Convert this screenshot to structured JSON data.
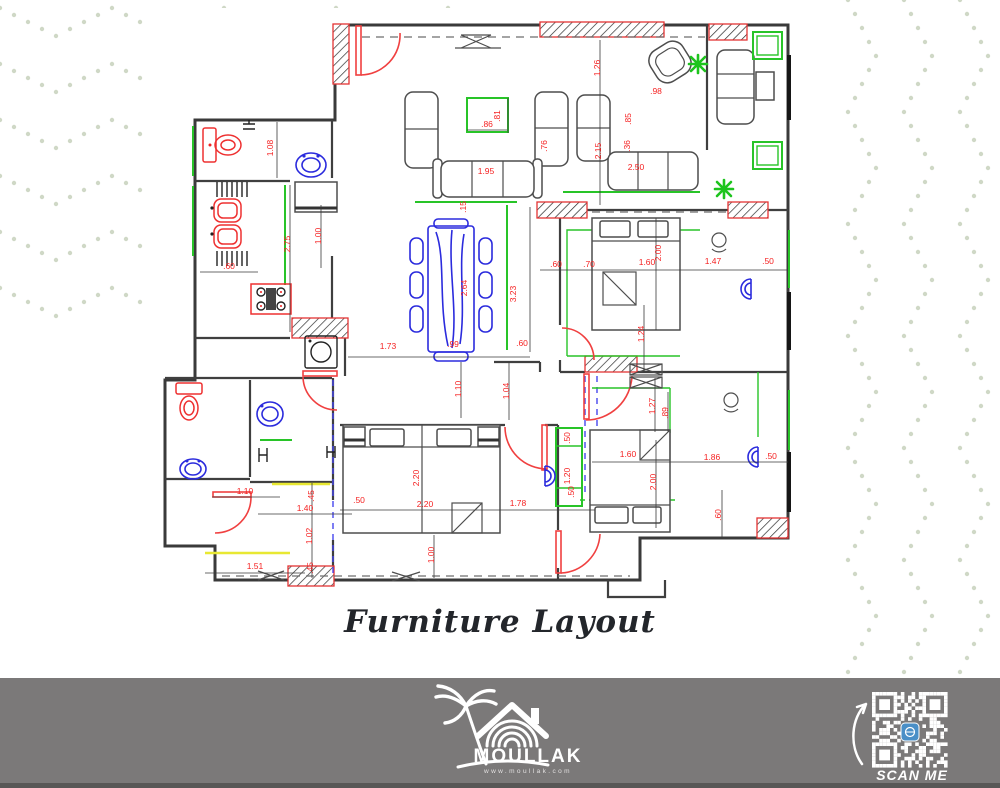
{
  "page": {
    "title": "Furniture Layout"
  },
  "footer": {
    "brand": "MOULLAK",
    "website": "www.moullak.com",
    "qr_label": "SCAN ME",
    "bar_color": "#7b7979"
  },
  "colors": {
    "dimension_text": "#f52222",
    "wall": "#3a3a3a",
    "accent_green": "#28c428",
    "fixture_blue": "#2b2bdd",
    "door_red": "#f04040",
    "pattern_dots": "#cfd8c6",
    "footer_gray": "#7b7979"
  },
  "plan": {
    "dimension_unit": "m",
    "dimensions": [
      {
        "v": "1.08",
        "x": 273,
        "y": 148,
        "r": -90
      },
      {
        "v": "1.26",
        "x": 600,
        "y": 68,
        "r": -90
      },
      {
        "v": ".98",
        "x": 656,
        "y": 94,
        "r": 0
      },
      {
        "v": ".86",
        "x": 487,
        "y": 127,
        "r": 0
      },
      {
        "v": ".81",
        "x": 500,
        "y": 116,
        "r": -90
      },
      {
        "v": ".76",
        "x": 547,
        "y": 146,
        "r": -90
      },
      {
        "v": ".85",
        "x": 631,
        "y": 119,
        "r": -90
      },
      {
        "v": ".36",
        "x": 630,
        "y": 146,
        "r": -90
      },
      {
        "v": "2.15",
        "x": 601,
        "y": 151,
        "r": -90
      },
      {
        "v": "1.95",
        "x": 486,
        "y": 174,
        "r": 0
      },
      {
        "v": "2.50",
        "x": 636,
        "y": 170,
        "r": 0
      },
      {
        "v": ".15",
        "x": 466,
        "y": 207,
        "r": -90
      },
      {
        "v": "2.75",
        "x": 290,
        "y": 244,
        "r": -90
      },
      {
        "v": "1.00",
        "x": 321,
        "y": 236,
        "r": -90
      },
      {
        "v": ".60",
        "x": 229,
        "y": 269,
        "r": 0
      },
      {
        "v": "1.73",
        "x": 388,
        "y": 349,
        "r": 0
      },
      {
        "v": "2.64",
        "x": 467,
        "y": 288,
        "r": -90
      },
      {
        "v": ".99",
        "x": 453,
        "y": 347,
        "r": 0
      },
      {
        "v": "3.23",
        "x": 516,
        "y": 294,
        "r": -90
      },
      {
        "v": ".60",
        "x": 556,
        "y": 267,
        "r": 0
      },
      {
        "v": ".70",
        "x": 589,
        "y": 267,
        "r": 0
      },
      {
        "v": "1.60",
        "x": 647,
        "y": 265,
        "r": 0
      },
      {
        "v": "2.00",
        "x": 661,
        "y": 253,
        "r": -90
      },
      {
        "v": "1.47",
        "x": 713,
        "y": 264,
        "r": 0
      },
      {
        "v": ".50",
        "x": 768,
        "y": 264,
        "r": 0
      },
      {
        "v": "1.24",
        "x": 644,
        "y": 334,
        "r": -90
      },
      {
        "v": ".60",
        "x": 522,
        "y": 346,
        "r": 0
      },
      {
        "v": "1.10",
        "x": 461,
        "y": 389,
        "r": -90
      },
      {
        "v": "1.04",
        "x": 509,
        "y": 391,
        "r": -90
      },
      {
        "v": "1.27",
        "x": 655,
        "y": 406,
        "r": -90
      },
      {
        "v": ".89",
        "x": 668,
        "y": 413,
        "r": -90
      },
      {
        "v": "1.60",
        "x": 628,
        "y": 457,
        "r": 0
      },
      {
        "v": "1.86",
        "x": 712,
        "y": 460,
        "r": 0
      },
      {
        "v": ".50",
        "x": 771,
        "y": 459,
        "r": 0
      },
      {
        "v": "2.00",
        "x": 656,
        "y": 482,
        "r": -90
      },
      {
        "v": ".60",
        "x": 721,
        "y": 515,
        "r": -90
      },
      {
        "v": "2.20",
        "x": 419,
        "y": 478,
        "r": -90
      },
      {
        "v": "2.20",
        "x": 425,
        "y": 507,
        "r": 0
      },
      {
        "v": "1.78",
        "x": 518,
        "y": 506,
        "r": 0
      },
      {
        "v": "1.00",
        "x": 434,
        "y": 555,
        "r": -90
      },
      {
        "v": ".50",
        "x": 570,
        "y": 438,
        "r": -90
      },
      {
        "v": "1.20",
        "x": 570,
        "y": 476,
        "r": -90
      },
      {
        "v": ".50",
        "x": 574,
        "y": 492,
        "r": -90
      },
      {
        "v": ".50",
        "x": 359,
        "y": 503,
        "r": 0
      },
      {
        "v": "1.10",
        "x": 245,
        "y": 494,
        "r": 0
      },
      {
        "v": ".45",
        "x": 314,
        "y": 496,
        "r": -90
      },
      {
        "v": "1.40",
        "x": 305,
        "y": 511,
        "r": 0
      },
      {
        "v": "1.02",
        "x": 312,
        "y": 536,
        "r": -90
      },
      {
        "v": "1.51",
        "x": 255,
        "y": 569,
        "r": 0
      },
      {
        "v": ".45",
        "x": 313,
        "y": 568,
        "r": -90
      }
    ]
  }
}
